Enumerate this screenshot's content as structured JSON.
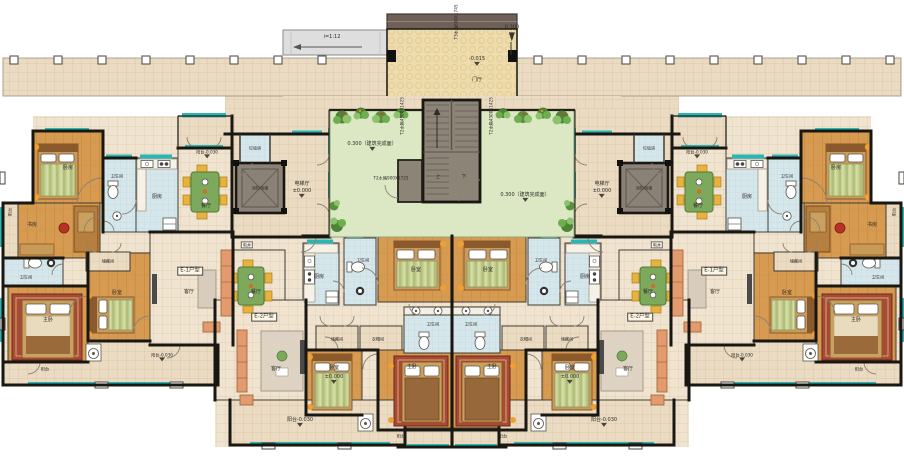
{
  "labels": {
    "bedroom": "卧室",
    "bedroom2": "卧房",
    "master": "主卧",
    "living": "客厅",
    "dining": "餐厅",
    "kitchen": "厨房",
    "bath": "卫生间",
    "study": "书房",
    "storage": "储藏间",
    "closet": "衣帽间",
    "balcony": "阳台",
    "balcony_lvl": "阳台-0.030",
    "elev_hall": "电梯厅",
    "fire_elev": "消防电梯",
    "garbage": "垃圾房",
    "eshaft": "电井",
    "foyer": "门厅",
    "up": "上",
    "down": "下",
    "unit_e1": "E-1户型",
    "unit_e2": "E-2户型",
    "ramp": "i=1:12",
    "lvl_zero": "±0.000",
    "lvl_m015": "-0.015",
    "lvl_0300": "0.300",
    "lvl_building": "0.300（建筑完成面）",
    "tank_t3": "T3水箱600X1745",
    "tank_t2a": "T2水箱4300X1425",
    "tank_t2b": "T2水箱900X1725"
  },
  "colors": {
    "wall": "#191712",
    "wood_floor": "#d69a50",
    "tile_floor": "#f0e3cf",
    "walkway_tile": "#eadbc2",
    "bath_tile": "#d6e7ec",
    "courtyard_green": "#dce8c4",
    "window_teal": "#28b6b4",
    "roof_brown": "#6f6158",
    "stair_grey": "#8d8478",
    "duvet_green": "#c6d193",
    "rug_red": "#a84a38",
    "chair_yellow": "#e8b23c"
  }
}
